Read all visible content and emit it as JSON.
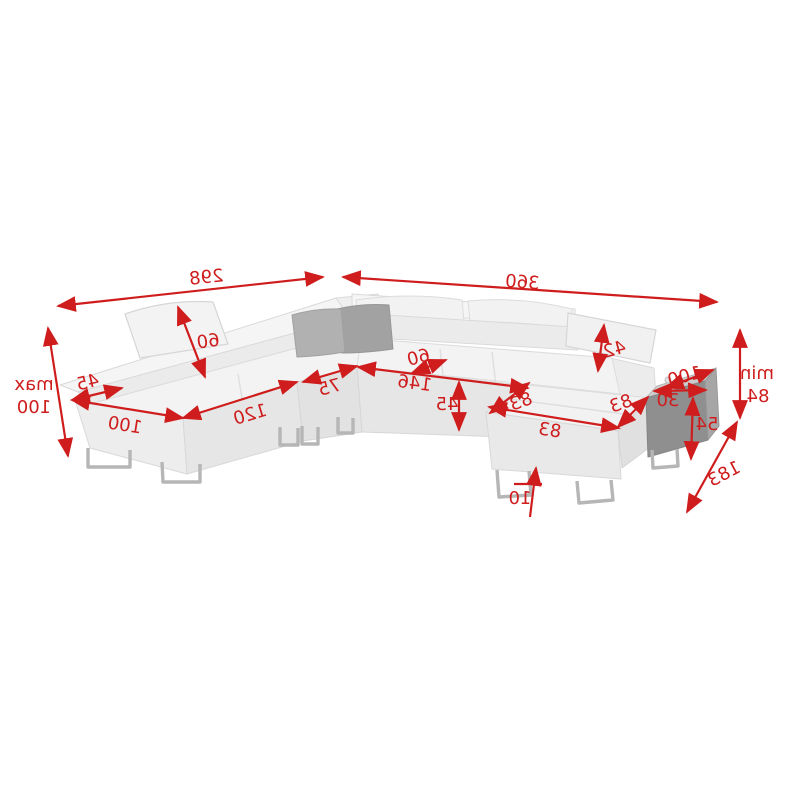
{
  "figure": {
    "type": "furniture-dimension-diagram",
    "subject": "corner-sofa-with-ottoman-and-side-table",
    "text_orientation": "mirrored"
  },
  "dimensions": {
    "top_left_width": "298",
    "top_right_width": "360",
    "left_max_label": "max",
    "left_max_value": "100",
    "left_back_ledge": "45",
    "left_end_width": "100",
    "headrest_left_height": "60",
    "front_seat_120": "120",
    "corner_seat_75": "75",
    "seat_depth_60": "60",
    "seat_length_146": "146",
    "seat_height_45": "45",
    "headrest_right_height": "42",
    "ottoman_left_83": "83",
    "ottoman_right_83": "83",
    "ottoman_front_83": "83",
    "table_length_100": "100",
    "table_width_30": "30",
    "table_height_54": "54",
    "right_min_label": "min",
    "right_min_value": "84",
    "depth_183": "183",
    "leg_height_10": "10"
  },
  "colors": {
    "dimension_red": "#cf1d1d",
    "body_light": "#f4f4f4",
    "body_front": "#e9e9e9",
    "body_shade": "#dfdfdf",
    "pillow_gray_light": "#b0b0b0",
    "pillow_gray_dark": "#a0a0a0",
    "table_top": "#cccccc",
    "table_front": "#8f8f8f",
    "table_side": "#a6a6a6",
    "leg_metal": "#b6b6b6",
    "background": "#ffffff"
  }
}
